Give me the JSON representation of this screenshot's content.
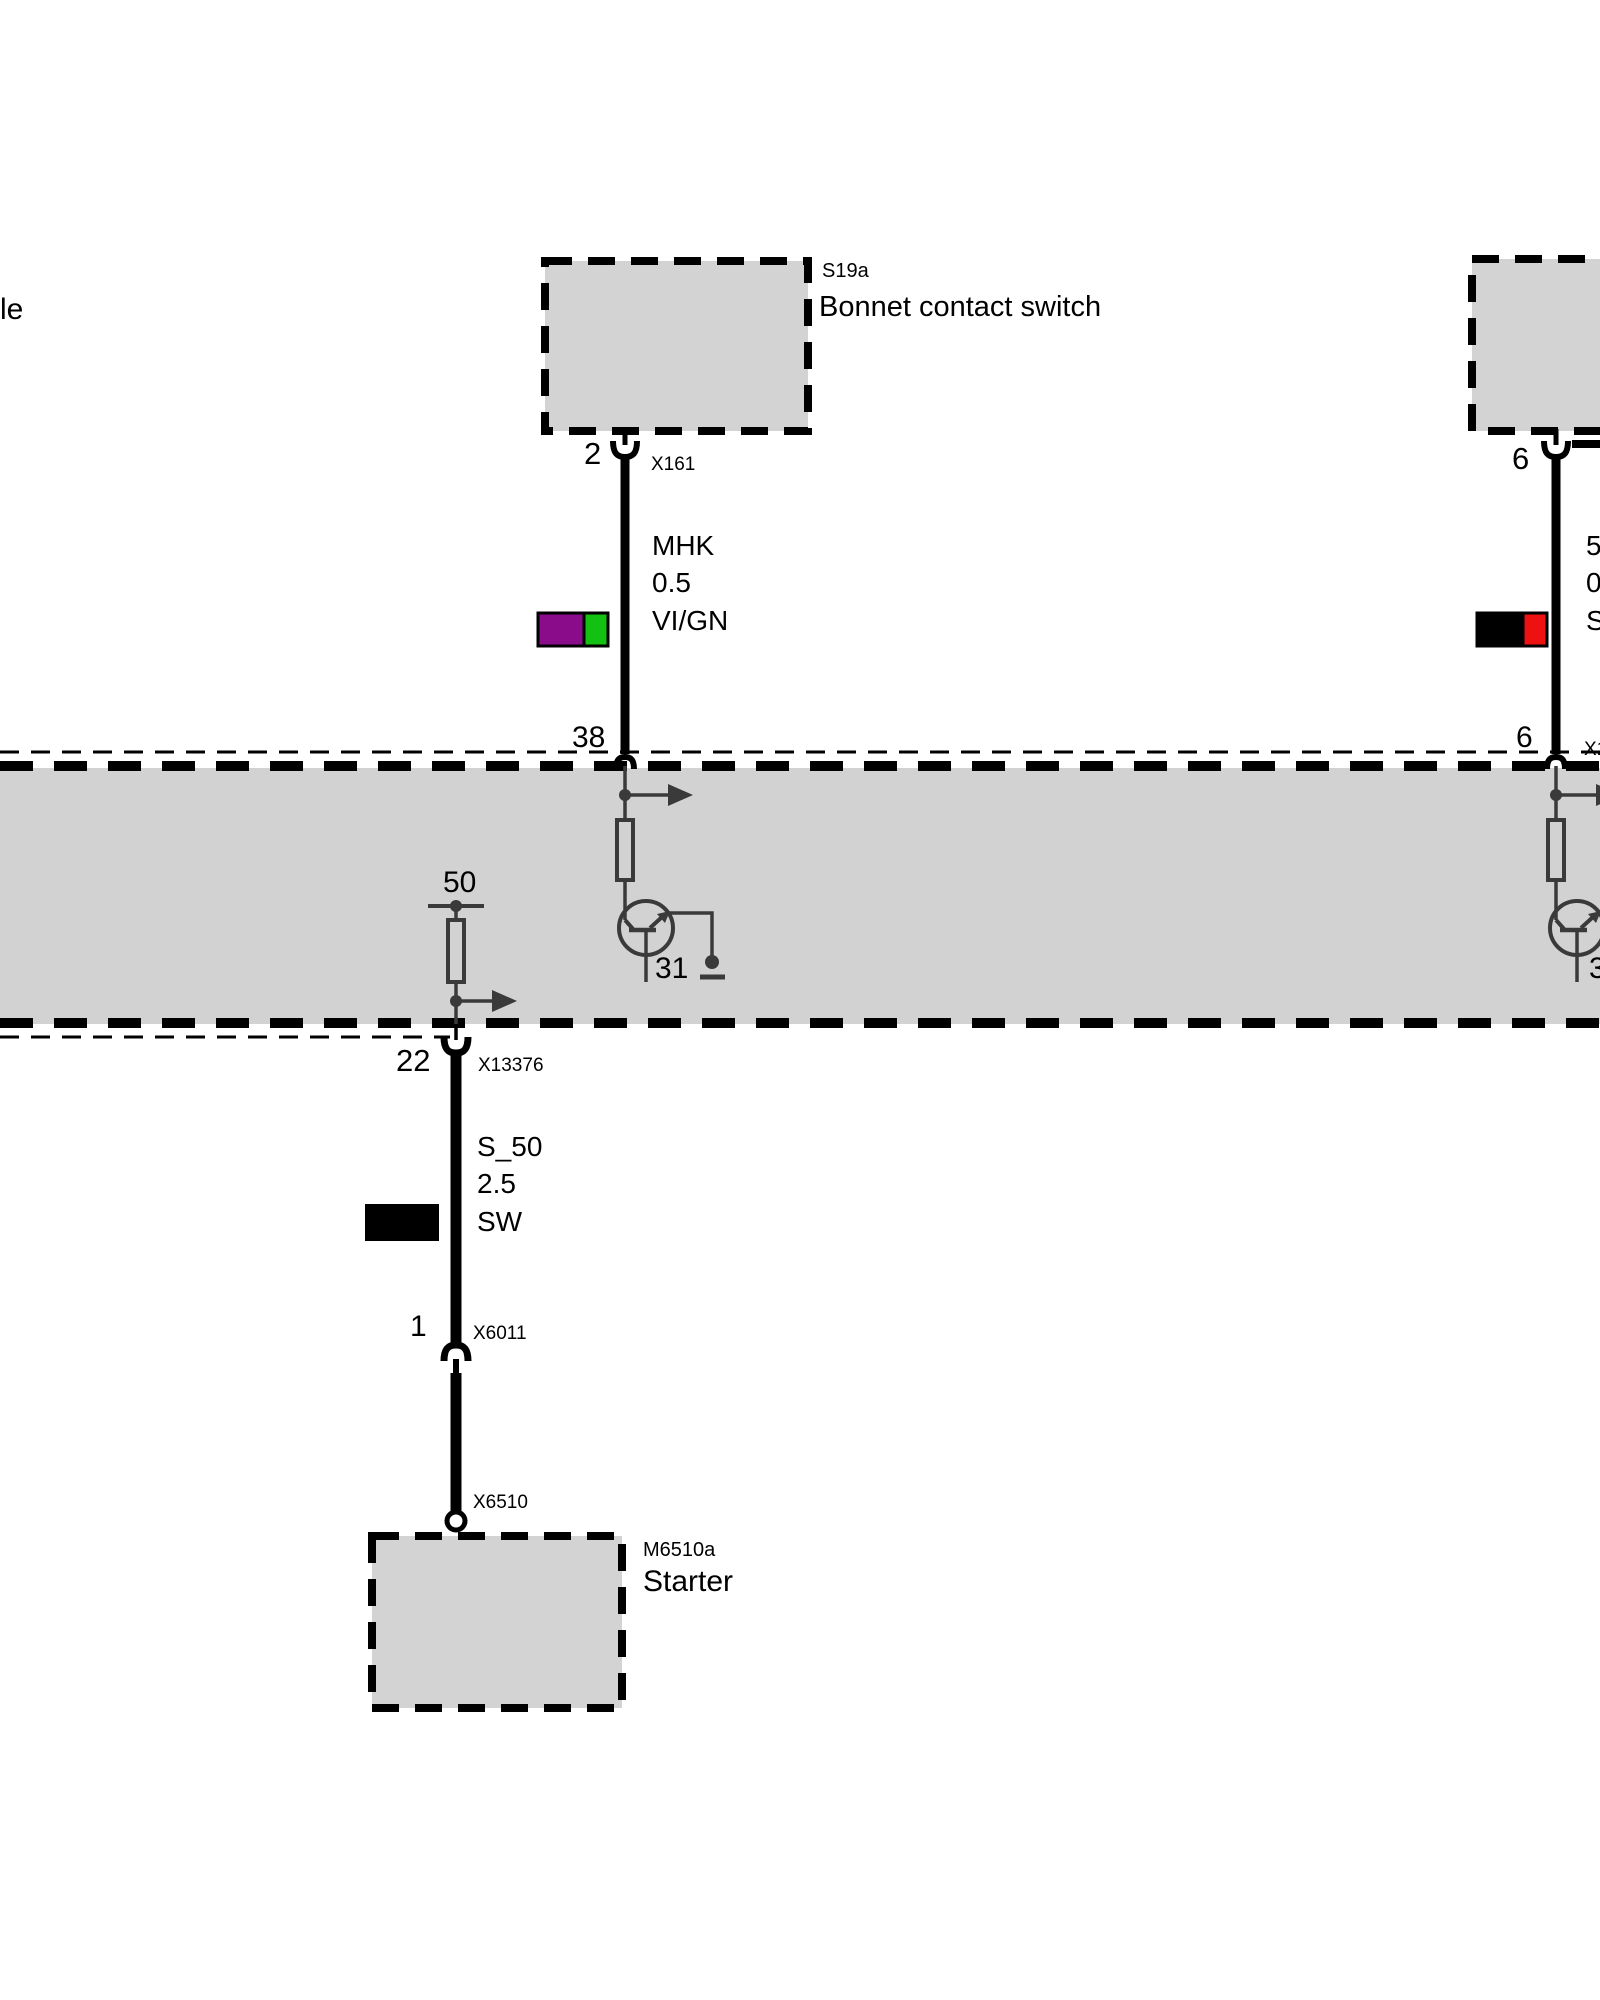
{
  "page": {
    "left_text_fragment": "le"
  },
  "bonnet_switch": {
    "id": "S19a",
    "name": "Bonnet contact switch",
    "pin": "2",
    "connector": "X161"
  },
  "wire_mhk": {
    "name": "MHK",
    "gauge": "0.5",
    "color_code": "VI/GN"
  },
  "module": {
    "pin38": "38",
    "term50": "50",
    "term31": "31",
    "term31_right_fragment": "3",
    "pin22": "22",
    "connector_pin22": "X13376",
    "pin6": "6",
    "connector_pin6_fragment": "X1"
  },
  "wire_s50": {
    "name": "S_50",
    "gauge": "2.5",
    "color_code": "SW"
  },
  "starter_path": {
    "pin1": "1",
    "connector_x6011": "X6011",
    "connector_x6510": "X6510"
  },
  "starter": {
    "id": "M6510a",
    "name": "Starter"
  },
  "right_branch": {
    "pin_top": "6",
    "wire_line1": "50",
    "wire_line2": "0.",
    "wire_line3": "S"
  },
  "colors": {
    "module_fill": "#D2D2D2",
    "box_fill": "#D3D3D3",
    "violet": "#8A0C8A",
    "green": "#12C112",
    "red": "#EE1111",
    "black": "#000000",
    "internal_stroke": "#3A3A3A"
  }
}
